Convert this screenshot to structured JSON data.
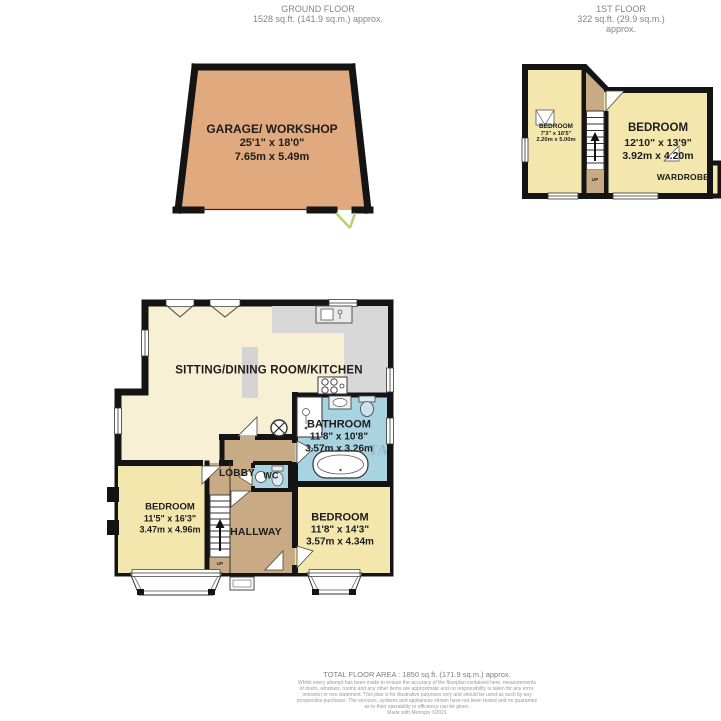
{
  "headers": {
    "ground_floor": {
      "title": "GROUND FLOOR",
      "area": "1528 sq.ft. (141.9 sq.m.) approx."
    },
    "first_floor": {
      "title": "1ST FLOOR",
      "area": "322 sq.ft. (29.9 sq.m.) approx."
    }
  },
  "garage": {
    "name": "GARAGE/ WORKSHOP",
    "dims_imperial": "25'1\"  x 18'0\"",
    "dims_metric": "7.65m  x 5.49m"
  },
  "first_floor": {
    "bedroom_small": {
      "name": "BEDROOM",
      "dims_imperial": "7'3\"  x 16'5\"",
      "dims_metric": "2.20m  x 5.00m"
    },
    "bedroom_large": {
      "name": "BEDROOM",
      "dims_imperial": "12'10\"  x 13'9\"",
      "dims_metric": "3.92m  x 4.20m"
    },
    "wardrobe_label": "WARDROBE",
    "up_label": "UP"
  },
  "ground_floor": {
    "sitting_room": {
      "name": "SITTING/DINING ROOM/KITCHEN"
    },
    "bathroom": {
      "name": "BATHROOM",
      "dims_imperial": "11'8\"  x 10'8\"",
      "dims_metric": "3.57m  x 3.26m"
    },
    "lobby": {
      "name": "LOBBY"
    },
    "wc": {
      "name": "WC"
    },
    "bedroom_left": {
      "name": "BEDROOM",
      "dims_imperial": "11'5\"  x 16'3\"",
      "dims_metric": "3.47m  x 4.96m"
    },
    "bedroom_right": {
      "name": "BEDROOM",
      "dims_imperial": "11'8\"  x 14'3\"",
      "dims_metric": "3.57m  x 4.34m"
    },
    "hallway": {
      "name": "HALLWAY"
    },
    "up_label": "UP",
    "watermark": "TA"
  },
  "footer": {
    "total_area": "TOTAL FLOOR AREA : 1850 sq.ft. (171.9 sq.m.) approx.",
    "disclaimer_lines": [
      "Whilst every attempt has been made to ensure the accuracy of the floorplan contained here, measurements",
      "of doors, windows, rooms and any other items are approximate and no responsibility is taken for any error,",
      "omission or mis-statement. This plan is for illustrative purposes only and should be used as such by any",
      "prospective purchaser. The services, systems and appliances shown have not been tested and no guarantee",
      "as to their operability or efficiency can be given.",
      "Made with Metropix ©2021"
    ]
  },
  "colors": {
    "wall": "#141414",
    "sitting_room_fill": "#f7f0d4",
    "bedroom_fill": "#f3e7ae",
    "hall_fill": "#c8ab85",
    "bath_fill": "#a8d3e1",
    "kitchen_gray": "#d8d8d8",
    "garage_fill": "#e1a97e",
    "door_swing_green": "#b9cf72"
  }
}
